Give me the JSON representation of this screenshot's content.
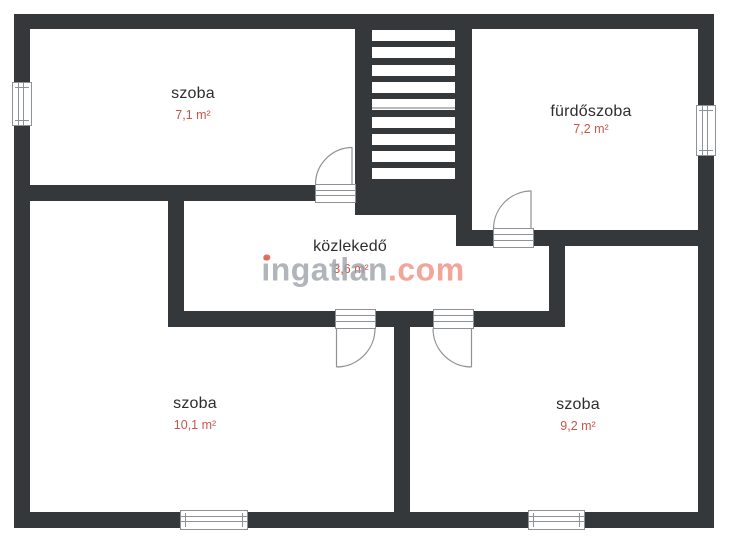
{
  "colors": {
    "background": "#ffffff",
    "wall": "#35383a",
    "symbol-line": "#8e9296",
    "room-name": "#2d2d2d",
    "room-area": "#cb5647",
    "watermark-gray": "#9ba1a8",
    "watermark-accent": "#f2a193",
    "watermark-dot": "#e2604b"
  },
  "staircase": {
    "treads": 9
  },
  "rooms": [
    {
      "name": "szoba",
      "area": "7,1 m²"
    },
    {
      "name": "fürdőszoba",
      "area": "7,2 m²"
    },
    {
      "name": "közlekedő",
      "area": "3,6 m²"
    },
    {
      "name": "szoba",
      "area": "10,1 m²"
    },
    {
      "name": "szoba",
      "area": "9,2 m²"
    }
  ],
  "watermark": {
    "part1": "ingatlan",
    "part2": ".com"
  }
}
